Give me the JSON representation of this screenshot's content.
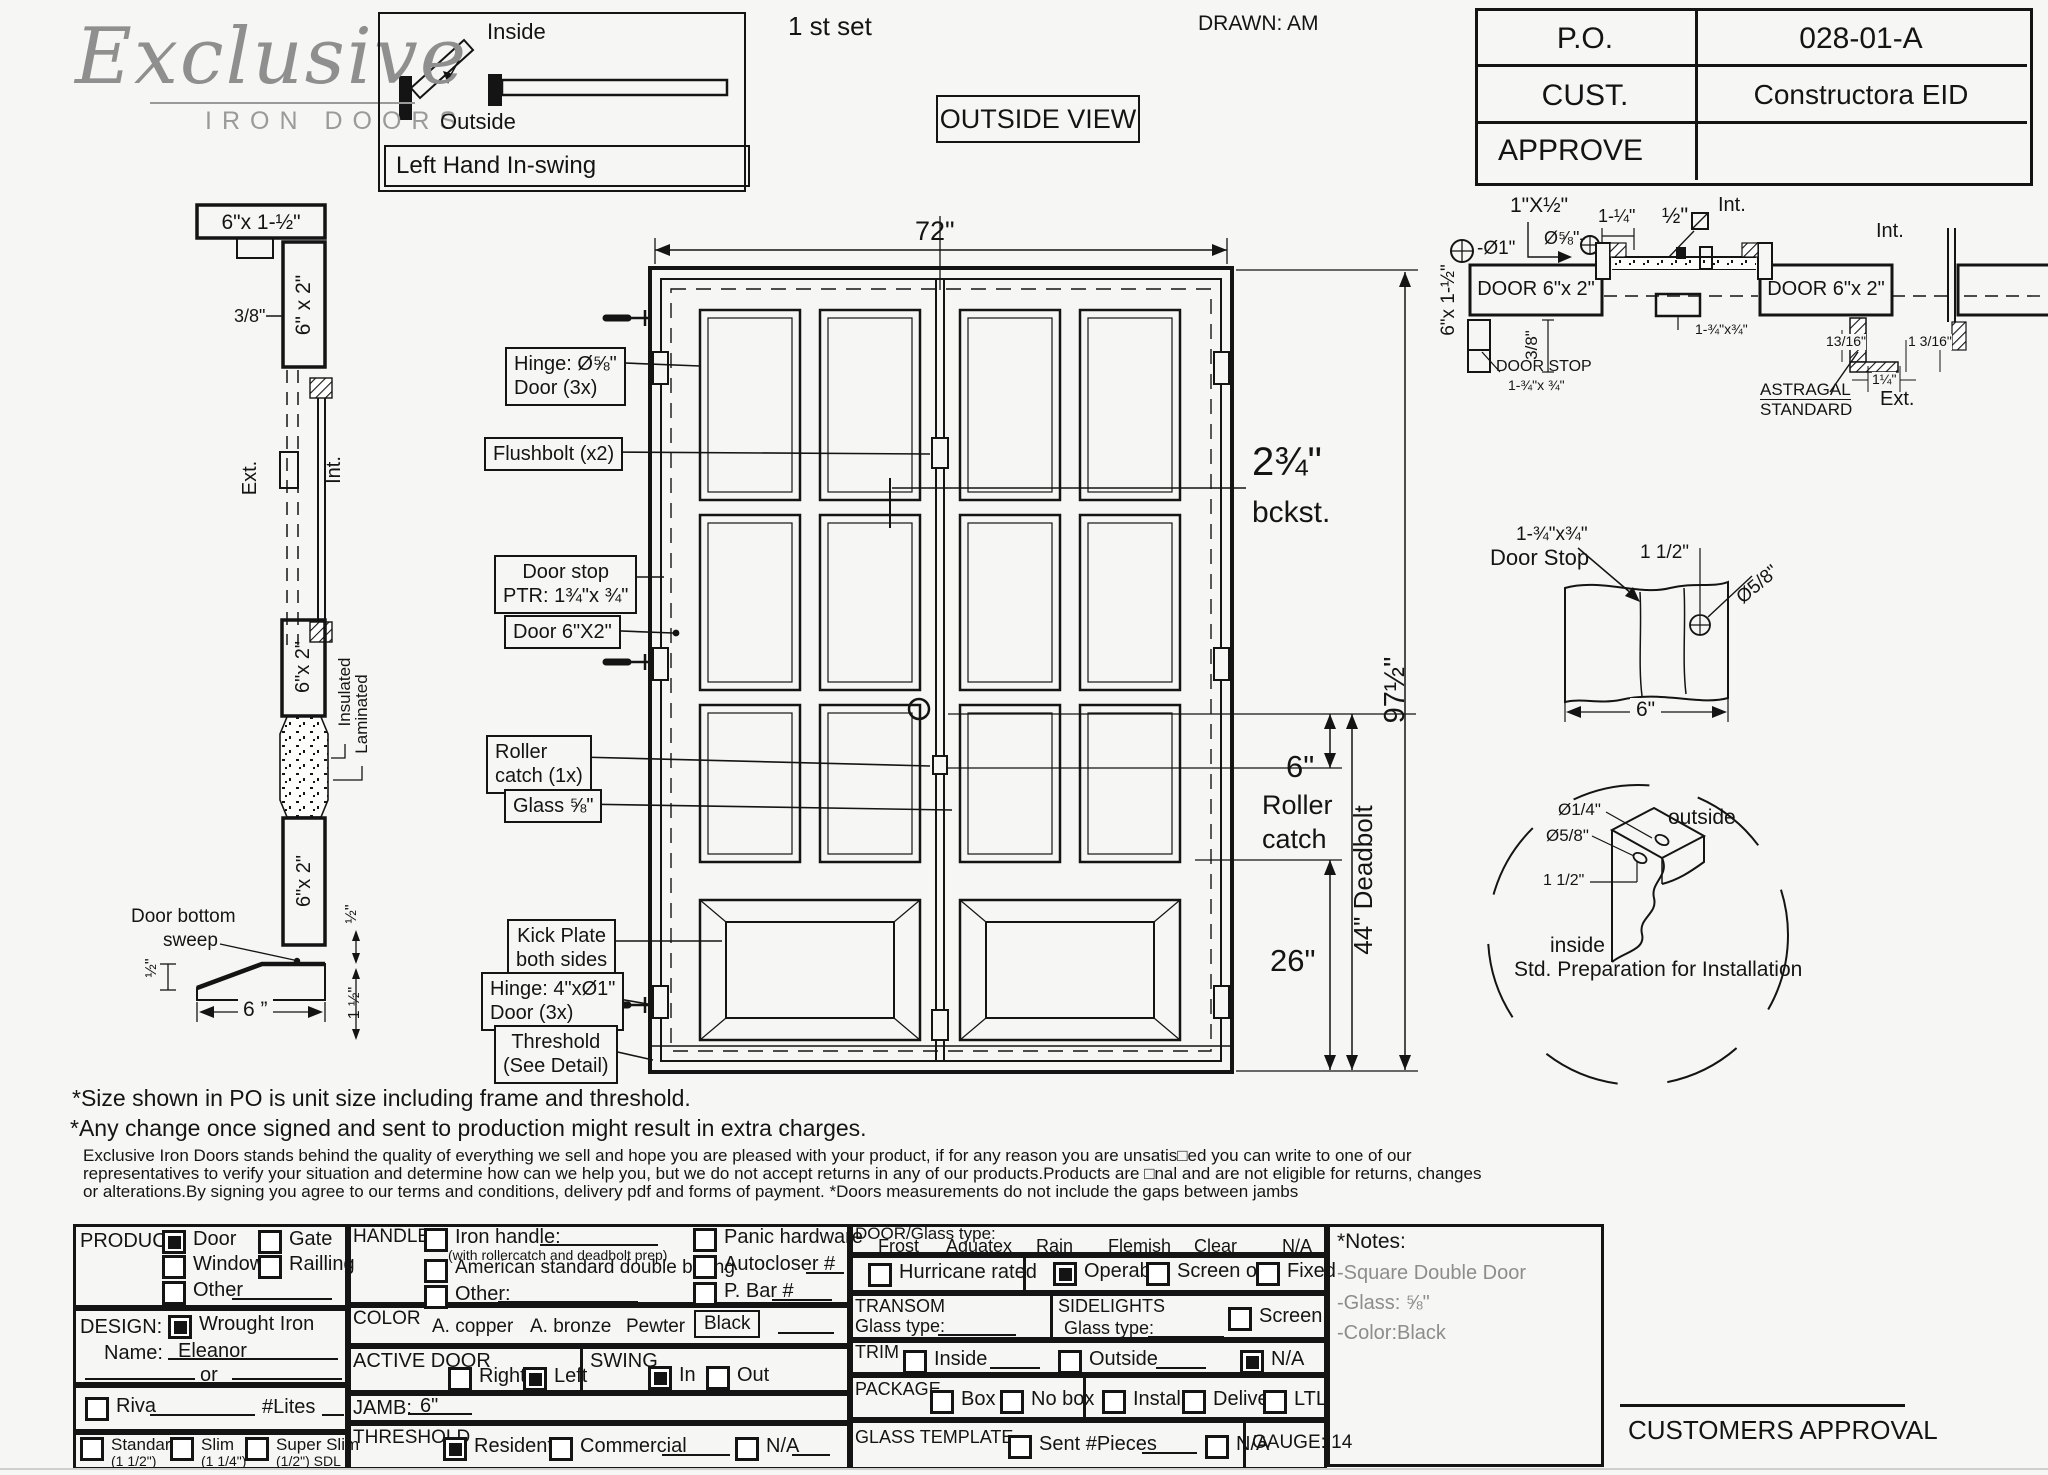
{
  "header": {
    "logo_main": "Exclusive",
    "logo_sub": "IRON DOORS",
    "set_label": "1 st set",
    "drawn": "DRAWN: AM",
    "view": "OUTSIDE VIEW",
    "swing_inside": "Inside",
    "swing_outside": "Outside",
    "swing_caption": "Left Hand In-swing",
    "po_label": "P.O.",
    "po_value": "028-01-A",
    "cust_label": "CUST.",
    "cust_value": "Constructora EID",
    "approve_label": "APPROVE",
    "approve_value": ""
  },
  "jamb_section": {
    "top_dim": "6\"x 1-½\"",
    "gap": "3/8\"",
    "jamb": "6\" x 2\"",
    "ext": "Ext.",
    "int": "Int.",
    "ins1": "Insulated",
    "ins2": "Laminated",
    "door_a": "6\"x 2\"",
    "door_b": "6\"x 2\"",
    "sweep1": "Door bottom",
    "sweep2": "sweep",
    "half_a": "½\"",
    "half_b": "½\"",
    "one_half": "1 ½\"",
    "width6": "6 ”"
  },
  "elevation": {
    "w72": "72\"",
    "h97": "97½\"",
    "bckst1": "2¾\"",
    "bckst2": "bckst.",
    "roller6": "6\"",
    "roller_w1": "Roller",
    "roller_w2": "catch",
    "deadbolt": "44\" Deadbolt",
    "kick26": "26\"",
    "lb_hinge1": "Hinge: Ø⅝\"",
    "lb_hinge2": "Door (3x)",
    "lb_flush": "Flushbolt (x2)",
    "lb_stop1": "Door stop",
    "lb_stop2": "PTR: 1¾\"x ¾\"",
    "lb_door62": "Door 6\"X2\"",
    "lb_roller1": "Roller",
    "lb_roller2": "catch  (1x)",
    "lb_glass": "Glass ⅝\"",
    "lb_kick1": "Kick Plate",
    "lb_kick2": "both sides",
    "lb_hingeb1": "Hinge: 4\"xØ1\"",
    "lb_hingeb2": "Door (3x)",
    "lb_thr1": "Threshold",
    "lb_thr2": "(See Detail)"
  },
  "hsec": {
    "d1x12": "1\"X½\"",
    "dia58": "Ø⅝\"-",
    "dia1": "-Ø1\"",
    "d114": "1-¼\"",
    "d12": "½\"",
    "int1": "Int.",
    "int2": "Int.",
    "door_l": "DOOR 6\"x 2\"",
    "door_r": "DOOR 6\"x 2\"",
    "jamb_v": "6\"x 1-½\"",
    "d38": "3/8\"",
    "stop1": "DOOR STOP",
    "stop2": "1-¾\"x ¾\"",
    "mid": "1-¾\"x¾\"",
    "d1316a": "13/16\"",
    "d1316b": "1 3/16\"",
    "d114b": "1¼\"",
    "astr1": "ASTRAGAL",
    "astr2": "STANDARD",
    "ext": "Ext."
  },
  "stop_detail": {
    "l1": "1-¾\"x¾\"",
    "l2": "Door Stop",
    "d112": "1 1/2\"",
    "dia": "Ø5/8\"",
    "w6": "6\""
  },
  "prep_detail": {
    "dia14": "Ø1/4\"",
    "dia58": "Ø5/8\"",
    "d112": "1 1/2\"",
    "outside": "outside",
    "inside": "inside",
    "caption": "Std. Preparation for Installation"
  },
  "notes": {
    "l1": "*Size shown in PO is unit size including frame and threshold.",
    "l2": "*Any change once signed and sent to production might result in extra charges.",
    "l3": "Exclusive Iron Doors stands behind the quality of everything we sell and hope you are pleased with your product, if for any reason you are unsatis□ed you can write to one of our",
    "l4": "representatives to verify your situation and determine how can we help you, but we do not accept returns in any of our products.Products are □nal and are not eligible for returns, changes",
    "l5": "or alterations.By signing you agree to our terms and conditions, delivery pdf and forms of payment. *Doors measurements do not include the gaps between jambs"
  },
  "form": {
    "product": {
      "label": "PRODUCT:",
      "door": {
        "label": "Door",
        "checked": true
      },
      "gate": {
        "label": "Gate",
        "checked": false
      },
      "window": {
        "label": "Window",
        "checked": false
      },
      "railling": {
        "label": "Railling",
        "checked": false
      },
      "other": {
        "label": "Other",
        "checked": false
      }
    },
    "design": {
      "label": "DESIGN:",
      "wrought": {
        "label": "Wrought Iron",
        "checked": true
      },
      "name_label": "Name:",
      "name_value": "Eleanor",
      "or_label": "or"
    },
    "riva": {
      "riva": {
        "label": "Riva",
        "checked": false
      },
      "lites_label": "#Lites"
    },
    "frame": {
      "standard": {
        "label": "Standard",
        "sub": "(1 1/2\")",
        "checked": false
      },
      "slim": {
        "label": "Slim",
        "sub": "(1 1/4\")",
        "checked": false
      },
      "superslim": {
        "label": "Super Slim",
        "sub": "(1/2\") SDL",
        "checked": false
      }
    },
    "handle": {
      "label": "HANDLE",
      "iron": {
        "label": "Iron handle:",
        "checked": false
      },
      "iron_sub": "(with rollercatch and deadbolt prep)",
      "american": {
        "label": "American standard double boring",
        "checked": false
      },
      "other": {
        "label": "Other:",
        "checked": false
      },
      "panic": {
        "label": "Panic hardware",
        "checked": false
      },
      "autocloser": {
        "label": "Autocloser #",
        "checked": false
      },
      "pbar": {
        "label": "P. Bar #",
        "checked": false
      }
    },
    "color": {
      "label": "COLOR",
      "copper": "A. copper",
      "bronze": "A. bronze",
      "pewter": "Pewter",
      "selected": "Black"
    },
    "active": {
      "label": "ACTIVE DOOR",
      "right": {
        "label": "Right",
        "checked": false
      },
      "left": {
        "label": "Left",
        "checked": true
      }
    },
    "swing": {
      "label": "SWING",
      "in": {
        "label": "In",
        "checked": true
      },
      "out": {
        "label": "Out",
        "checked": false
      }
    },
    "jamb": {
      "label": "JAMB:",
      "value": "6\""
    },
    "threshold": {
      "label": "THRESHOLD",
      "residential": {
        "label": "Residential",
        "checked": true
      },
      "commercial": {
        "label": "Commercial",
        "checked": false
      },
      "na": {
        "label": "N/A",
        "checked": false
      }
    },
    "glasstype": {
      "label": "DOOR/Glass type:",
      "frost": "Frost",
      "aquatex": "Aquatex",
      "rain": "Rain",
      "flemish": "Flemish",
      "clear": "Clear",
      "na": "N/A"
    },
    "hurricane": {
      "label": "Hurricane rated",
      "checked": false
    },
    "operable": {
      "label": "Operable",
      "checked": true
    },
    "screen_or": {
      "label": "Screen or",
      "checked": false
    },
    "fixed": {
      "label": "Fixed",
      "checked": false
    },
    "transom": {
      "label": "TRANSOM",
      "glass_label": "Glass type:"
    },
    "sidelights": {
      "label": "SIDELIGHTS",
      "glass_label": "Glass type:",
      "screen": {
        "label": "Screen",
        "checked": false
      }
    },
    "trim": {
      "label": "TRIM",
      "inside": {
        "label": "Inside",
        "checked": false
      },
      "outside": {
        "label": "Outside",
        "checked": false
      },
      "na": {
        "label": "N/A",
        "checked": true
      }
    },
    "package": {
      "label": "PACKAGE",
      "box": {
        "label": "Box",
        "checked": false
      },
      "nobox": {
        "label": "No box",
        "checked": false
      },
      "install": {
        "label": "Install",
        "checked": false
      },
      "delivery": {
        "label": "Delivery",
        "checked": false
      },
      "ltl": {
        "label": "LTL",
        "checked": false
      }
    },
    "gtemplate": {
      "label": "GLASS TEMPLATE",
      "sent": {
        "label": "Sent #Pieces",
        "checked": false
      },
      "na": {
        "label": "N/A",
        "checked": false
      }
    },
    "gauge": {
      "label": "GAUGE: 14"
    },
    "notes_box": {
      "title": "*Notes:",
      "n1": "-Square Double Door",
      "n2": "-Glass: ⅝\"",
      "n3": "-Color:Black"
    },
    "approval": "CUSTOMERS APPROVAL"
  }
}
